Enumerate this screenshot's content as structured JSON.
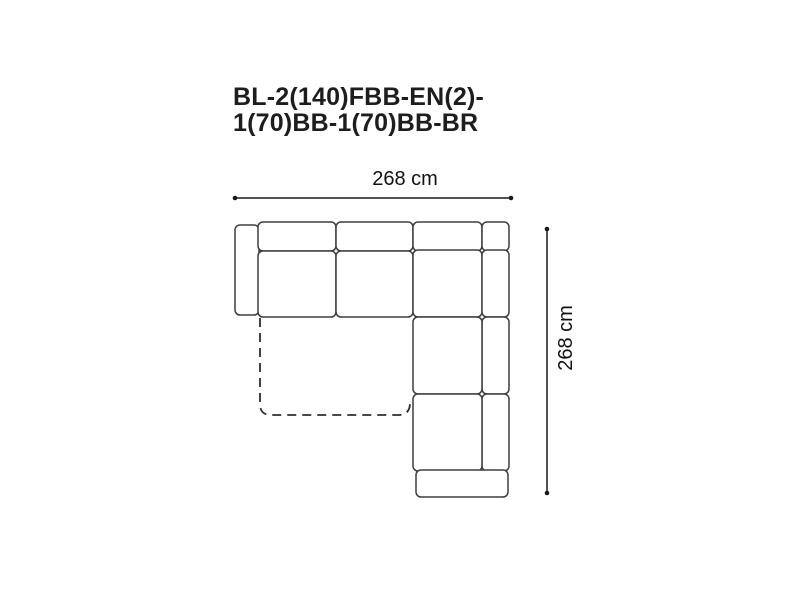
{
  "title": {
    "line1": "BL-2(140)FBB-EN(2)-",
    "line2": "1(70)BB-1(70)BB-BR"
  },
  "dimensions": {
    "width_label": "268 cm",
    "height_label": "268 cm"
  },
  "colors": {
    "background": "#ffffff",
    "sofa_outline": "#3e3e3e",
    "dimension_line": "#1a1a1a",
    "title_text": "#1d1d1d"
  }
}
